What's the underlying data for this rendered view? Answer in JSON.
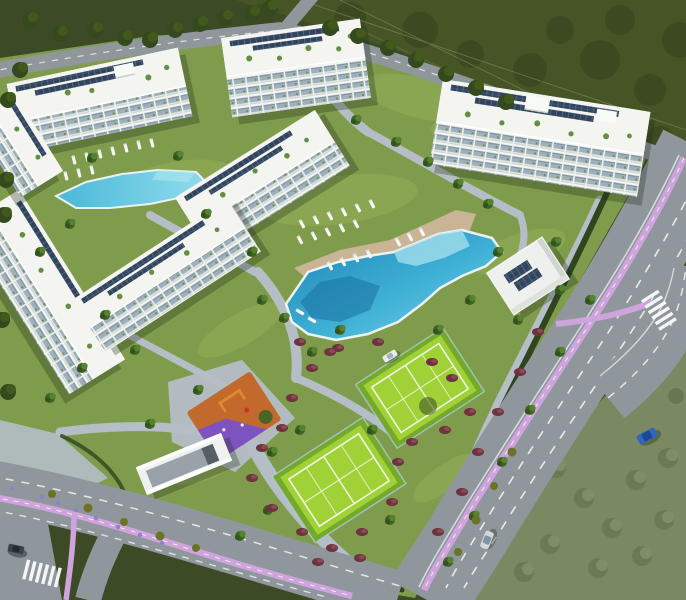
{
  "scene": {
    "type": "aerial-architectural-render",
    "description": "Bird's-eye 3D visualization of a white low-rise Mediterranean apartment complex with landscaped gardens, a lagoon pool with sun loungers, a second pool, two green padel courts, an orange and purple playground, a solar-roofed clubhouse and perimeter roads with pink cycle lanes, surrounded by dark green fields",
    "time_of_day": "daylight"
  },
  "counts": {
    "apartment_buildings": 7,
    "swimming_pools": 2,
    "padel_courts": 2,
    "playgrounds": 1,
    "clubhouses": 1,
    "crosswalks": 3,
    "cars": 4,
    "parking_ramps": 1
  },
  "amenities": [
    {
      "name": "main-lagoon-pool",
      "water": "turquoise-blue",
      "deck": "beige with white sun loungers"
    },
    {
      "name": "upper-left-pool",
      "water": "turquoise",
      "deck": "lounger rows on lawn"
    },
    {
      "name": "padel-court-north",
      "surface": "bright green with white lines"
    },
    {
      "name": "padel-court-south",
      "surface": "bright green with white lines"
    },
    {
      "name": "playground",
      "surface_colors": [
        "orange",
        "purple"
      ]
    },
    {
      "name": "clubhouse",
      "roof": "white with solar panels"
    },
    {
      "name": "underground-parking-ramp",
      "color": "white walls"
    }
  ],
  "buildings_style": "white 4-5 storey blocks, balcony facades, rooftop solar panels and roof gardens",
  "roads": {
    "bike_lane_color_name": "pink-lilac",
    "markings": "white dashed lane lines and zebra crosswalks",
    "layout": "avenue along east side curving to a junction, road along south-west corner, crossing at top"
  },
  "cars": [
    {
      "name": "silver-car",
      "color": "#d3d7da",
      "location": "east avenue"
    },
    {
      "name": "blue-car",
      "color": "#2f66c0",
      "location": "east junction"
    },
    {
      "name": "dark-car",
      "color": "#3b424a",
      "location": "south-west corner"
    },
    {
      "name": "white-parked-car",
      "color": "#e8ecee",
      "location": "inner lane near courts"
    }
  ],
  "palette": {
    "vegetationDark": "#3c4a26",
    "vegetationField": "#475526",
    "vegetationStreak": "#5f6e35",
    "scrub": "#7a8962",
    "scrubDark": "#68774f",
    "grass": "#7f9c4c",
    "grassLight": "#95b059",
    "road": "#8f979d",
    "roadLight": "#a3abb1",
    "bikeLane": "#cfa3dc",
    "marking": "#f2f4f5",
    "path": "#b5bec6",
    "building": "#edefeb",
    "buildingRoof": "#f4f5f1",
    "buildingGlass": "#9db0bc",
    "solarPanel": "#31445b",
    "poolDeep": "#1d83b5",
    "poolMid": "#3fb0d6",
    "poolShallow": "#7fd8ea",
    "deck": "#c9b496",
    "lounger": "#f5f7f4",
    "court": "#a0d137",
    "courtLine": "#eef7df",
    "courtBorder": "#76a82c",
    "playgroundOrange": "#c26a2e",
    "playgroundPurple": "#7a52c8",
    "hedge": "#2f4520",
    "shrubRed": "#6e3240",
    "palm": "#3e6323",
    "palmLight": "#55832f"
  }
}
